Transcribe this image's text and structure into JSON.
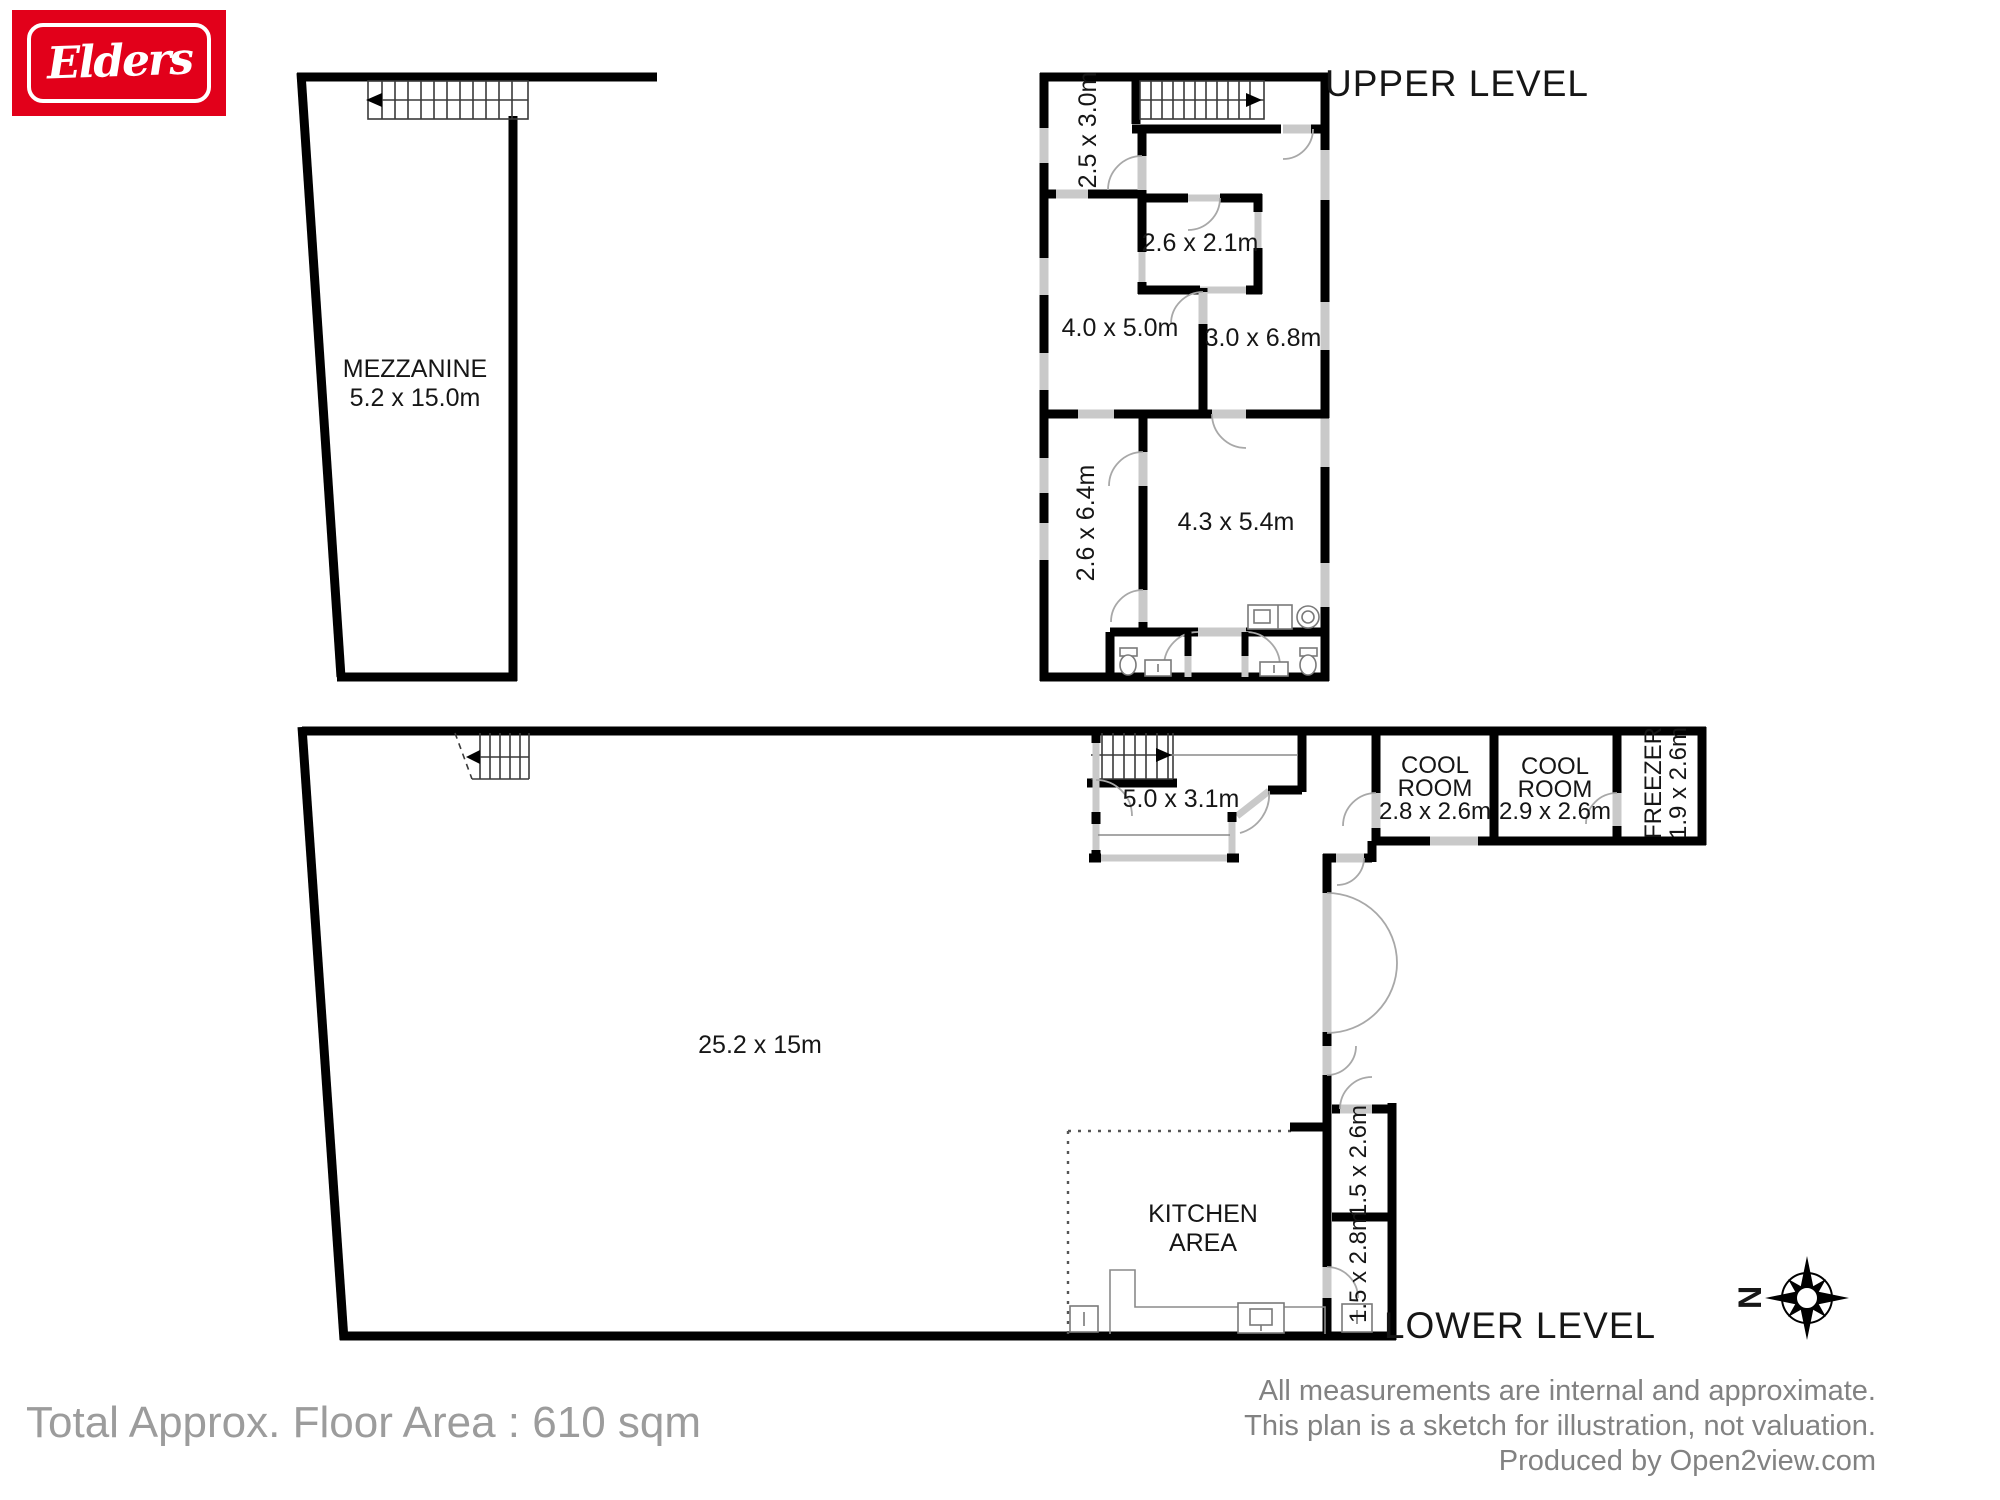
{
  "brand": {
    "name": "Elders"
  },
  "mezzanine": {
    "title": "MEZZANINE",
    "dims": "5.2 x 15.0m"
  },
  "upper": {
    "label": "UPPER LEVEL",
    "room_25x30": "2.5 x 3.0m",
    "room_26x21": "2.6 x 2.1m",
    "room_40x50": "4.0 x 5.0m",
    "room_30x68": "3.0 x 6.8m",
    "room_26x64": "2.6 x 6.4m",
    "room_43x54": "4.3 x 5.4m"
  },
  "lower": {
    "label": "LOWER LEVEL",
    "main_area": "25.2 x 15m",
    "office": "5.0 x 3.1m",
    "cool_room_1": {
      "line1": "COOL",
      "line2": "ROOM",
      "line3": "2.8 x 2.6m"
    },
    "cool_room_2": {
      "line1": "COOL",
      "line2": "ROOM",
      "line3": "2.9 x 2.6m"
    },
    "freezer": {
      "line1": "FREEZER",
      "line2": "1.9 x 2.6m"
    },
    "kitchen": {
      "line1": "KITCHEN",
      "line2": "AREA"
    },
    "store_1": "1.5 x 2.6m",
    "store_2": "1.5 x 2.8m"
  },
  "compass": {
    "north": "N"
  },
  "footer": {
    "total_area": "Total Approx. Floor Area : 610 sqm",
    "disclaimer_line1": "All measurements are internal and approximate.",
    "disclaimer_line2": "This plan is a sketch for illustration, not valuation.",
    "disclaimer_line3": "Produced by Open2view.com"
  },
  "colors": {
    "brand_red": "#e2001a",
    "wall": "#000000",
    "opening_gray": "#c9c9c9",
    "muted_text": "#9c9c9c",
    "disclaimer_text": "#828282"
  }
}
